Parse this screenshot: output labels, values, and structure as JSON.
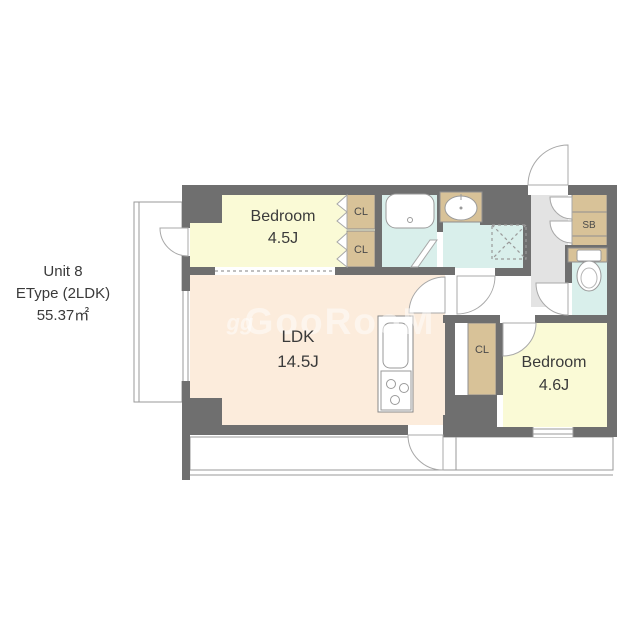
{
  "unit_info": {
    "unit": "Unit 8",
    "type": "EType (2LDK)",
    "area": "55.37㎡"
  },
  "watermark": {
    "icon": "gg",
    "brand": "GooRooM"
  },
  "rooms": {
    "bedroom1": {
      "name": "Bedroom",
      "area": "4.5J"
    },
    "ldk": {
      "name": "LDK",
      "area": "14.5J"
    },
    "bedroom2": {
      "name": "Bedroom",
      "area": "4.6J"
    }
  },
  "storage": {
    "cl1": "CL",
    "cl2": "CL",
    "cl3": "CL",
    "sb": "SB"
  },
  "colors": {
    "wall": "#6f6f6f",
    "bedroom_fill": "#fafad6",
    "ldk_fill": "#fcecdc",
    "wet_area_fill": "#d9efeb",
    "storage_fill": "#d8c298",
    "entrance_fill": "#e3e3e3",
    "outline": "#9a9a9a"
  }
}
